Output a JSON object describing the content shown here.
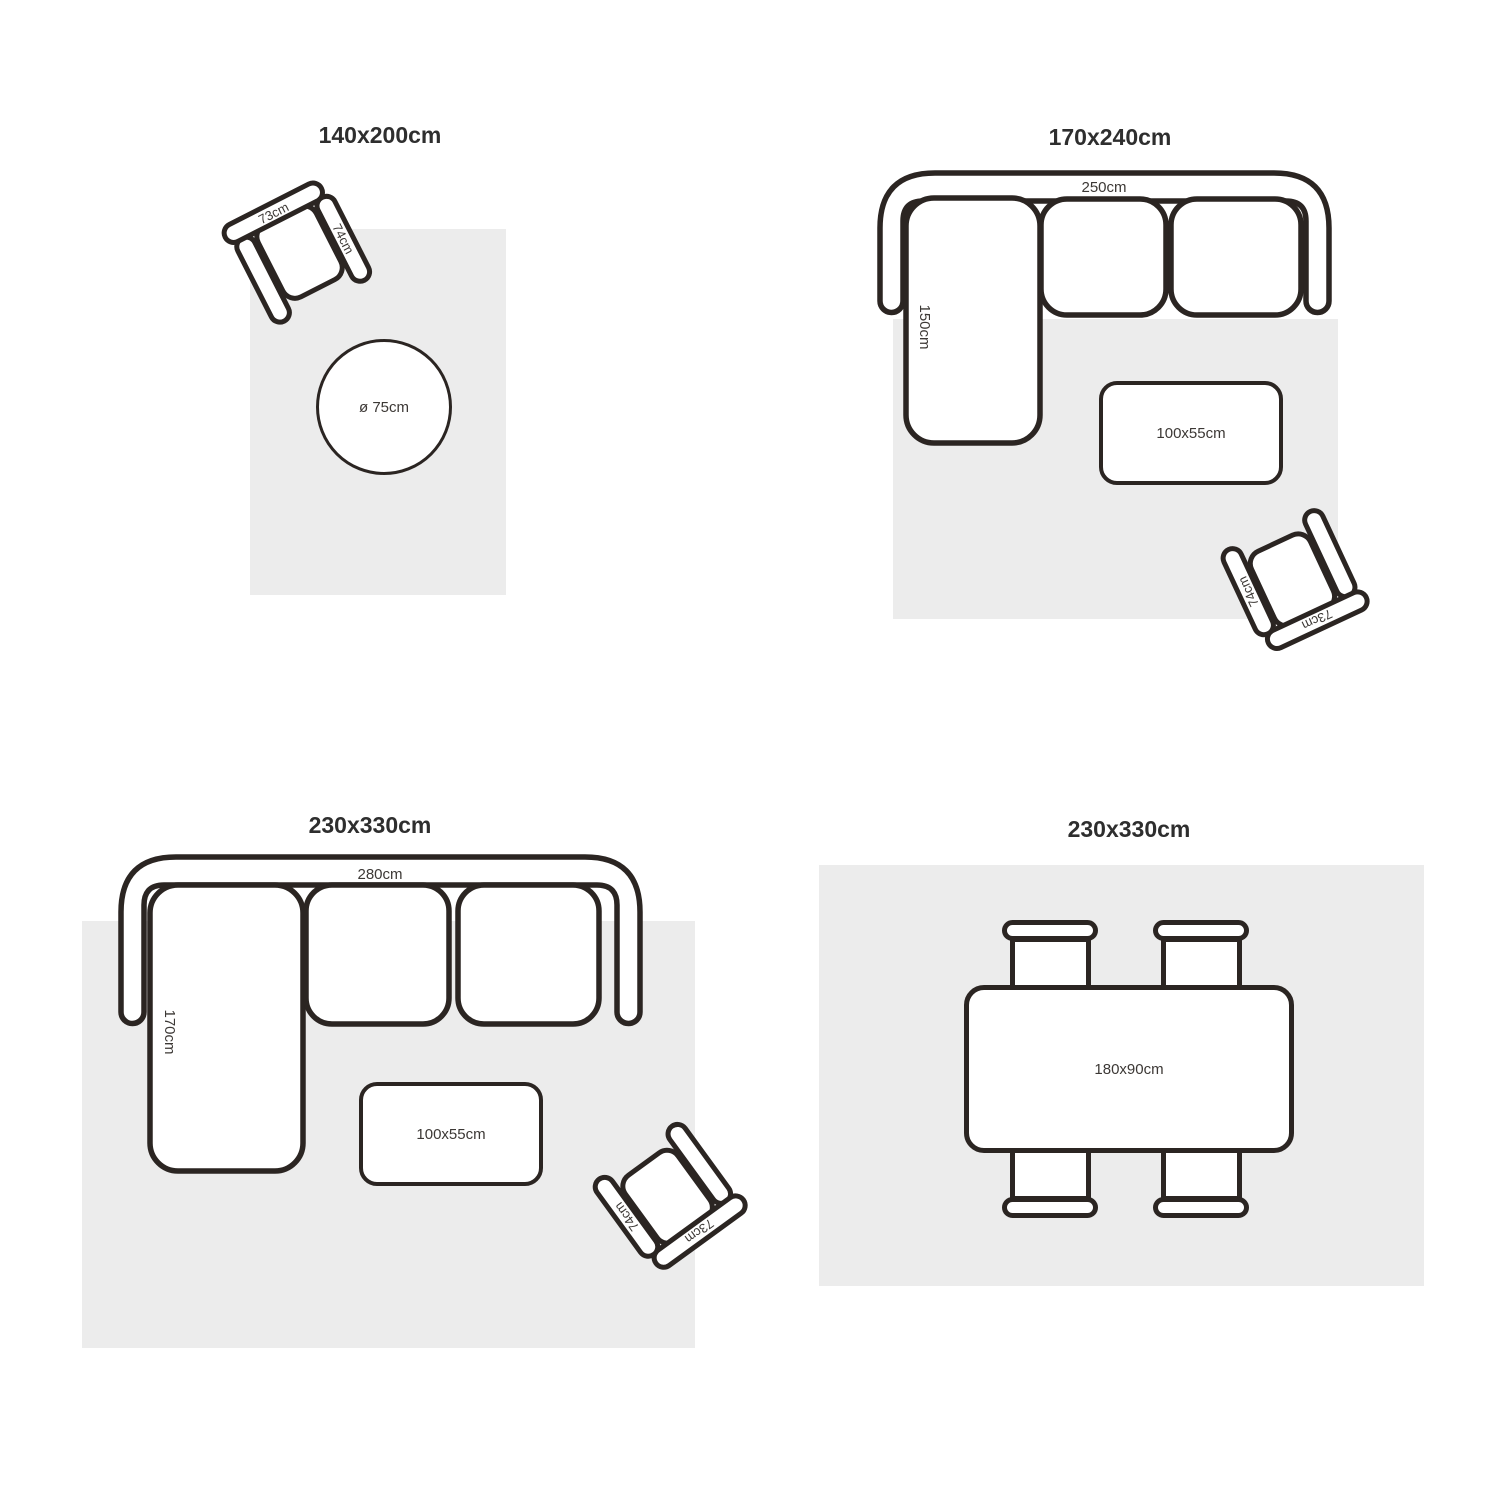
{
  "palette": {
    "background": "#ffffff",
    "rug_fill": "#ececec",
    "outline": "#2b2522",
    "title_text": "#2e2e2e",
    "label_text": "#3c3835"
  },
  "quadrants": {
    "top_left": {
      "title": "140x200cm",
      "armchair": {
        "back_label": "73cm",
        "arm_label": "74cm"
      },
      "round_table": {
        "label": "ø 75cm"
      }
    },
    "top_right": {
      "title": "170x240cm",
      "sofa": {
        "width_label": "250cm",
        "chaise_label": "150cm"
      },
      "coffee_table": {
        "label": "100x55cm"
      },
      "armchair": {
        "back_label": "73cm",
        "arm_label": "74cm"
      }
    },
    "bottom_left": {
      "title": "230x330cm",
      "sofa": {
        "width_label": "280cm",
        "chaise_label": "170cm"
      },
      "coffee_table": {
        "label": "100x55cm"
      },
      "armchair": {
        "back_label": "73cm",
        "arm_label": "74cm"
      }
    },
    "bottom_right": {
      "title": "230x330cm",
      "dining_table": {
        "label": "180x90cm"
      }
    }
  }
}
